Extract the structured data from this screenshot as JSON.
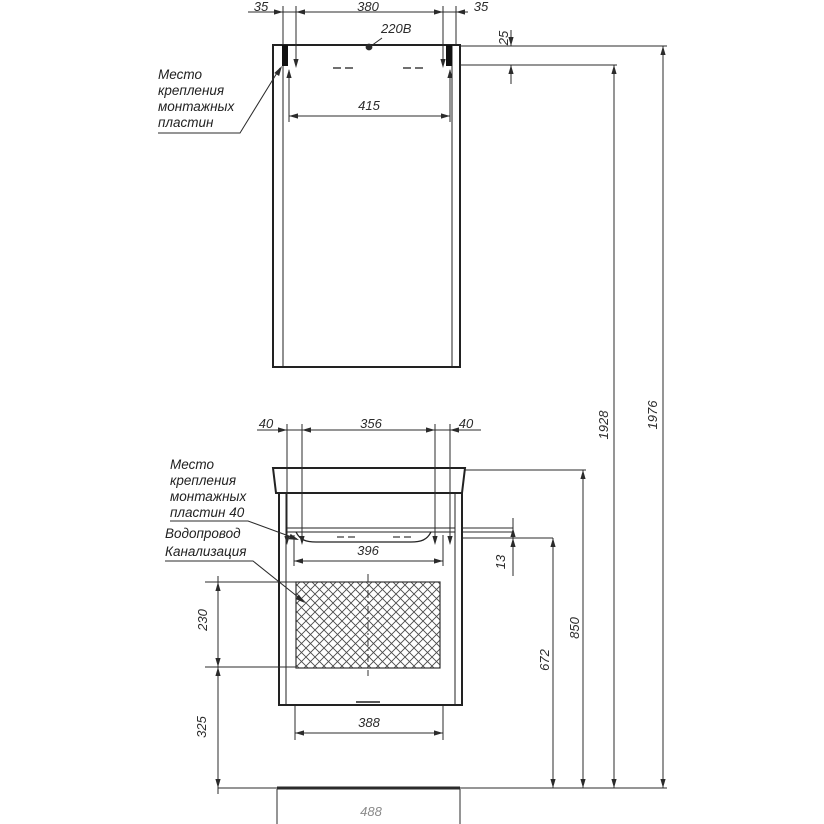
{
  "drawing": {
    "kind": "furniture-installation-scheme",
    "power_label": "220В",
    "upper_label_lines": [
      "Место",
      "крепления",
      "монтажных",
      "пластин"
    ],
    "lower_label_lines": [
      "Место",
      "крепления",
      "монтажных",
      "пластин 40"
    ],
    "utility_label_lines": [
      "Водопровод",
      "Канализация"
    ],
    "dims": {
      "top_left": "35",
      "top_center": "380",
      "top_right": "35",
      "offset_top": "25",
      "mirror_inner_width": "415",
      "low_left": "40",
      "low_center": "356",
      "low_right": "40",
      "basin_inner_width": "396",
      "gap": "13",
      "hatch_height": "230",
      "below_height": "325",
      "cabinet_bottom_width": "388",
      "cabinet_height": "672",
      "basin_height": "850",
      "mirror_bottom_height": "1928",
      "total_height": "1976",
      "base_width": "488"
    },
    "colors": {
      "line": "#2b2b2b",
      "outline": "#222222",
      "hatch": "#4a4a4a",
      "text": "#2b2b2b",
      "faint_text": "#8a8a8a",
      "background": "#ffffff"
    }
  }
}
